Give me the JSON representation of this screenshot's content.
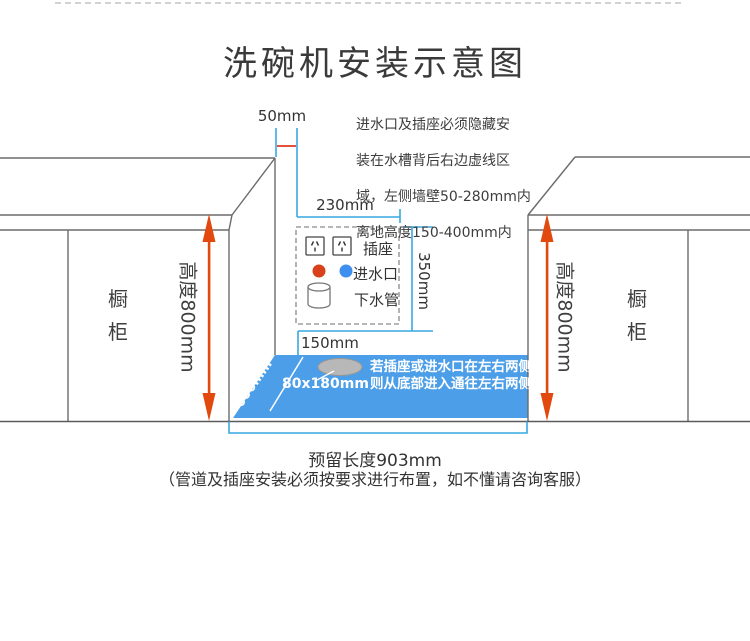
{
  "title": "洗碗机安装示意图",
  "install_note": {
    "lines": [
      "进水口及插座必须隐藏安",
      "装在水槽背后右边虚线区",
      "域，左侧墙壁50-280mm内",
      "离地高度150-400mm内"
    ]
  },
  "dims": {
    "wall_gap": "50mm",
    "zone_width": "230mm",
    "zone_height": "350mm",
    "zone_bottom_offset": "150mm",
    "floor_depth": "600mm",
    "hole_size": "80x180mm"
  },
  "zone": {
    "socket_label": "插座",
    "inlet_label": "进水口",
    "drain_label": "下水管"
  },
  "floor_note": {
    "lines": [
      "若插座或进水口在左右两侧",
      "则从底部进入通往左右两侧"
    ]
  },
  "cabinet_left": {
    "label": "橱柜",
    "height_label": "高度800mm"
  },
  "cabinet_right": {
    "label": "橱柜",
    "height_label": "高度800mm"
  },
  "bottom": {
    "reserve_label": "预留长度903mm",
    "caution": "（管道及插座安装必须按要求进行布置，如不懂请咨询客服）"
  },
  "icons": {
    "socket": "chinese-3pin-socket-icon",
    "inlet_hot": "red-dot-icon",
    "inlet_cold": "blue-dot-icon",
    "drain": "pipe-cylinder-icon",
    "floor_hole": "oval-hole-icon"
  },
  "colors": {
    "floor_blue": "#4b9ee7",
    "measure_blue": "#36a9e1",
    "arrow_red": "#e2490e",
    "ref_line_red": "#e03a20",
    "dot_red": "#d8411c",
    "dot_blue": "#3e8fee",
    "line_gray": "#6b6b6b",
    "text_dark": "#333333"
  }
}
